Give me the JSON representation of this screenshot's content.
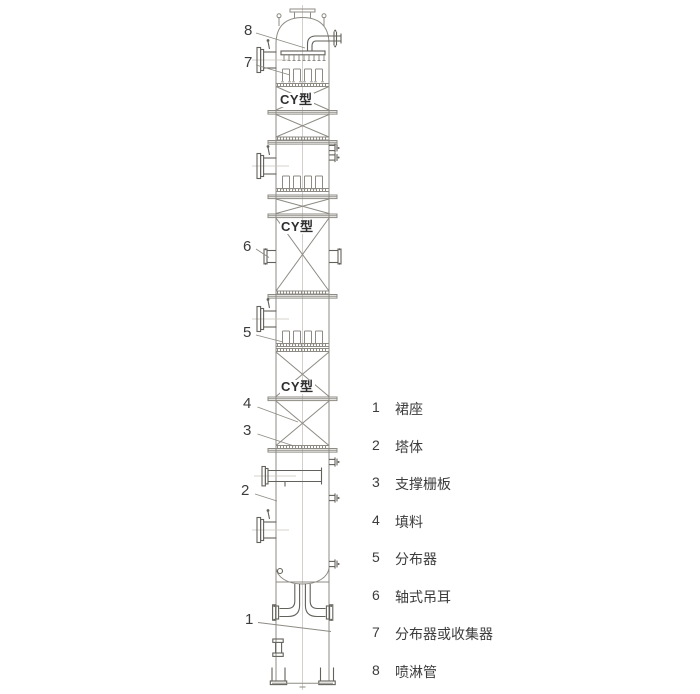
{
  "colors": {
    "line": "#8d8b83",
    "dark": "#63615b",
    "light": "#c7c5bd",
    "text": "#3c3c3c",
    "bg": "#ffffff"
  },
  "column": {
    "packing_type": "CY型"
  },
  "callouts": [
    {
      "num": "8"
    },
    {
      "num": "7"
    },
    {
      "num": "6"
    },
    {
      "num": "5"
    },
    {
      "num": "4"
    },
    {
      "num": "3"
    },
    {
      "num": "2"
    },
    {
      "num": "1"
    }
  ],
  "legend": {
    "items": [
      {
        "num": "1",
        "label": "裙座"
      },
      {
        "num": "2",
        "label": "塔体"
      },
      {
        "num": "3",
        "label": "支撑栅板"
      },
      {
        "num": "4",
        "label": "填料"
      },
      {
        "num": "5",
        "label": "分布器"
      },
      {
        "num": "6",
        "label": "轴式吊耳"
      },
      {
        "num": "7",
        "label": "分布器或收集器"
      },
      {
        "num": "8",
        "label": "喷淋管"
      }
    ]
  }
}
